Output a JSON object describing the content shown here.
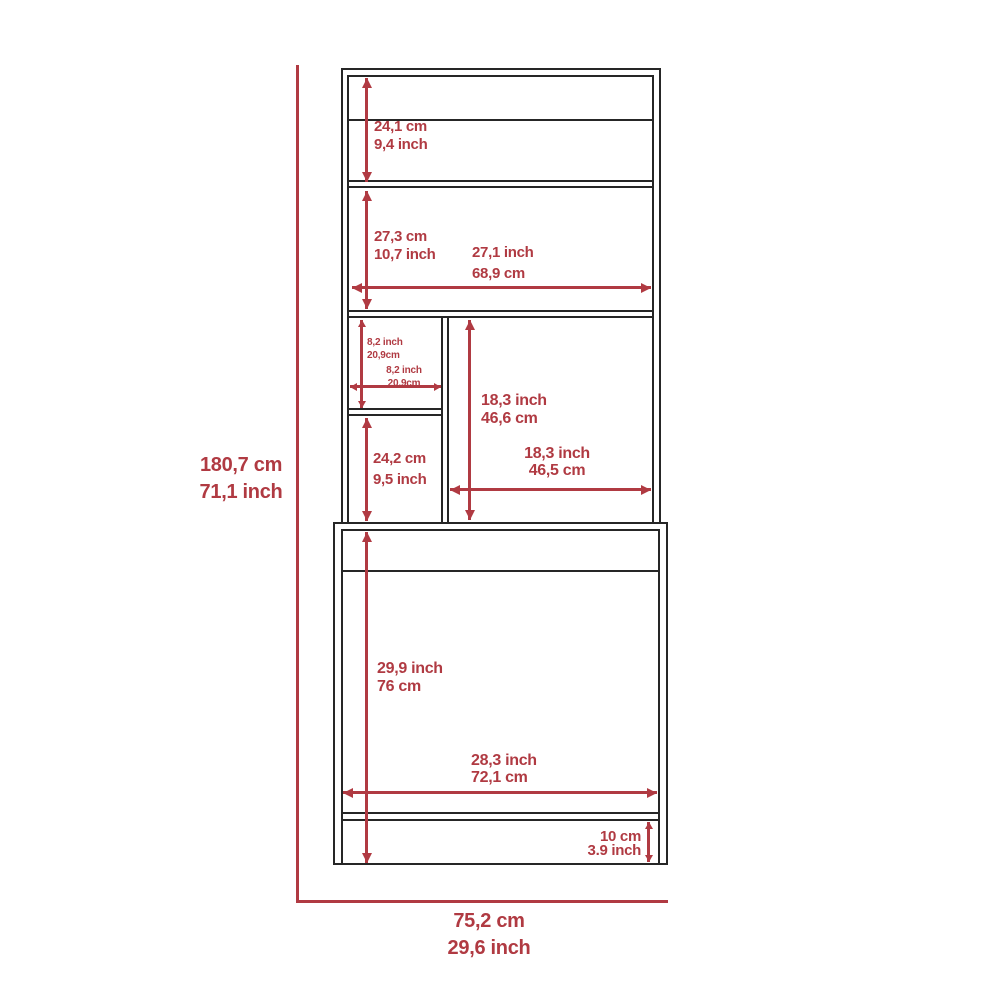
{
  "colors": {
    "dimension_accent": "#b03a42",
    "outline": "#262626",
    "background": "#ffffff"
  },
  "diagram": {
    "type": "furniture-dimension-diagram",
    "labels": {
      "overall_height": {
        "line1": "180,7 cm",
        "line2": "71,1 inch"
      },
      "overall_width": {
        "line1": "75,2 cm",
        "line2": "29,6 inch"
      },
      "top_shelf_height": {
        "line1": "24,1 cm",
        "line2": "9,4 inch"
      },
      "mid_shelf_height": {
        "line1": "27,3 cm",
        "line2": "10,7 inch"
      },
      "hutch_inner_width": {
        "line1": "27,1 inch",
        "line2": "68,9 cm"
      },
      "cubby_height": {
        "line1": "8,2 inch",
        "line2": "20,9cm"
      },
      "cubby_width": {
        "line1": "8,2 inch",
        "line2": "20,9cm"
      },
      "lower_cubby_height": {
        "line1": "24,2 cm",
        "line2": "9,5 inch"
      },
      "right_comp_height": {
        "line1": "18,3 inch",
        "line2": "46,6 cm"
      },
      "right_comp_width": {
        "line1": "18,3 inch",
        "line2": "46,5 cm"
      },
      "base_inner_height": {
        "line1": "29,9 inch",
        "line2": "76 cm"
      },
      "base_inner_width": {
        "line1": "28,3 inch",
        "line2": "72,1 cm"
      },
      "toe_kick_height": {
        "line1": "10 cm",
        "line2": "3.9 inch"
      }
    }
  }
}
